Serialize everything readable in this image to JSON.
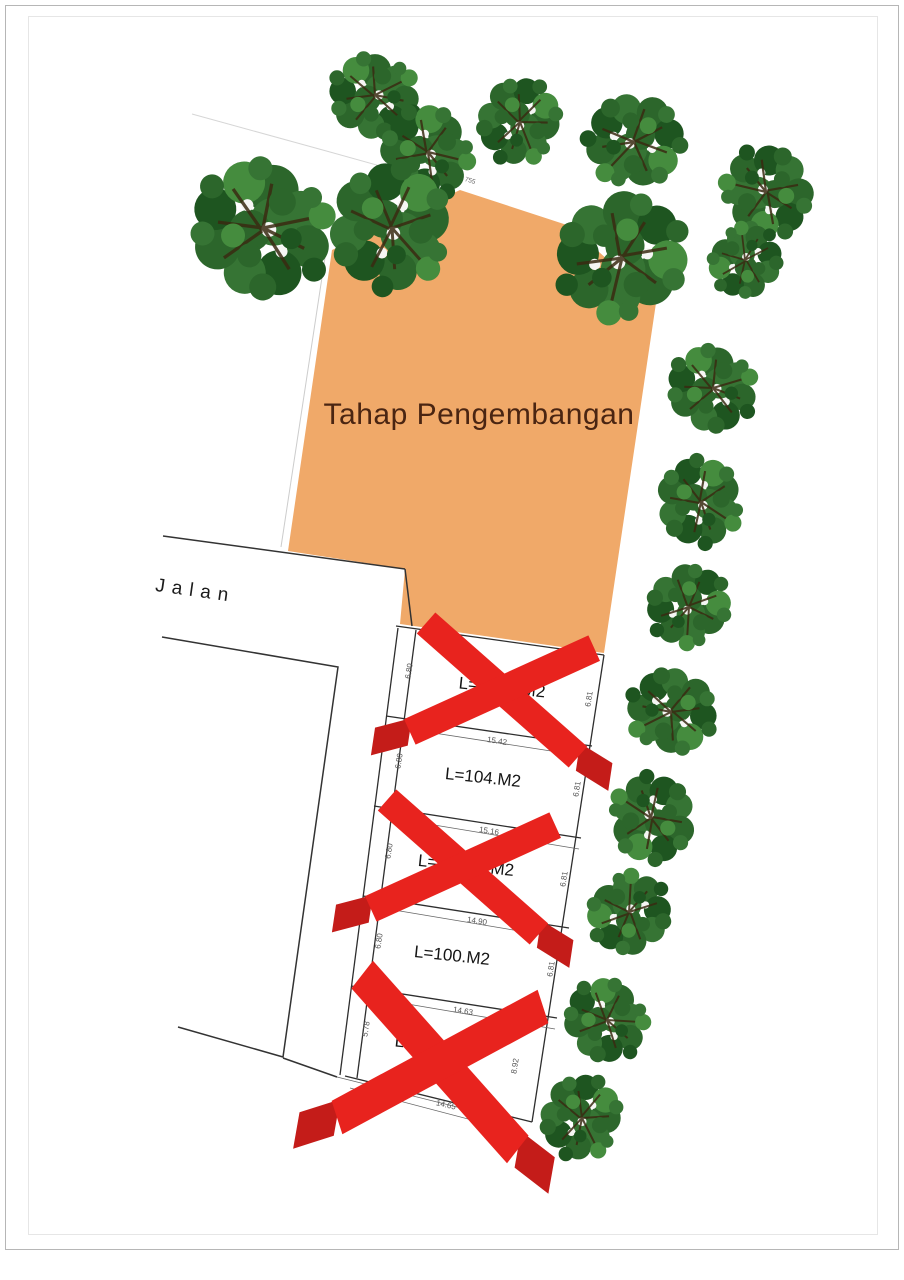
{
  "page": {
    "frame": {
      "outer_color": "#b6b6b6",
      "inner_color": "#e6e6e6"
    }
  },
  "plan": {
    "development_area": {
      "label": "Tahap Pengembangan",
      "top_dimension": "755"
    },
    "road_label": "Jalan",
    "plots": [
      {
        "name": "plot-1",
        "crossed_out": true,
        "label_left": "L=",
        "label_right": "M2",
        "dim_left": "6.80",
        "dim_right": "6.81",
        "dim_bottom": "15.42"
      },
      {
        "name": "plot-2",
        "crossed_out": false,
        "label": "L=104.M2",
        "dim_left": "6.80",
        "dim_right": "6.81",
        "dim_bottom": "15.16"
      },
      {
        "name": "plot-3",
        "crossed_out": true,
        "label_left": "L=1",
        "label_right": "M2",
        "dim_left": "6.80",
        "dim_right": "6.81",
        "dim_bottom": "14.90"
      },
      {
        "name": "plot-4",
        "crossed_out": false,
        "label": "L=100.M2",
        "dim_left": "6.80",
        "dim_right": "6.81",
        "dim_bottom": "14.63"
      },
      {
        "name": "plot-5",
        "crossed_out": true,
        "label_left": "L=",
        "label_right": "2",
        "dim_left": "5.78",
        "dim_right": "8.92",
        "dim_bottom": "14.65"
      }
    ],
    "colors": {
      "development_fill": "#f0a969",
      "development_text": "#4a2512",
      "cross_red": "#e8231e",
      "cross_fold_red": "#c41c19",
      "outline": "#2e2e2e",
      "dim_text": "#555555"
    },
    "tree_count": 17
  }
}
